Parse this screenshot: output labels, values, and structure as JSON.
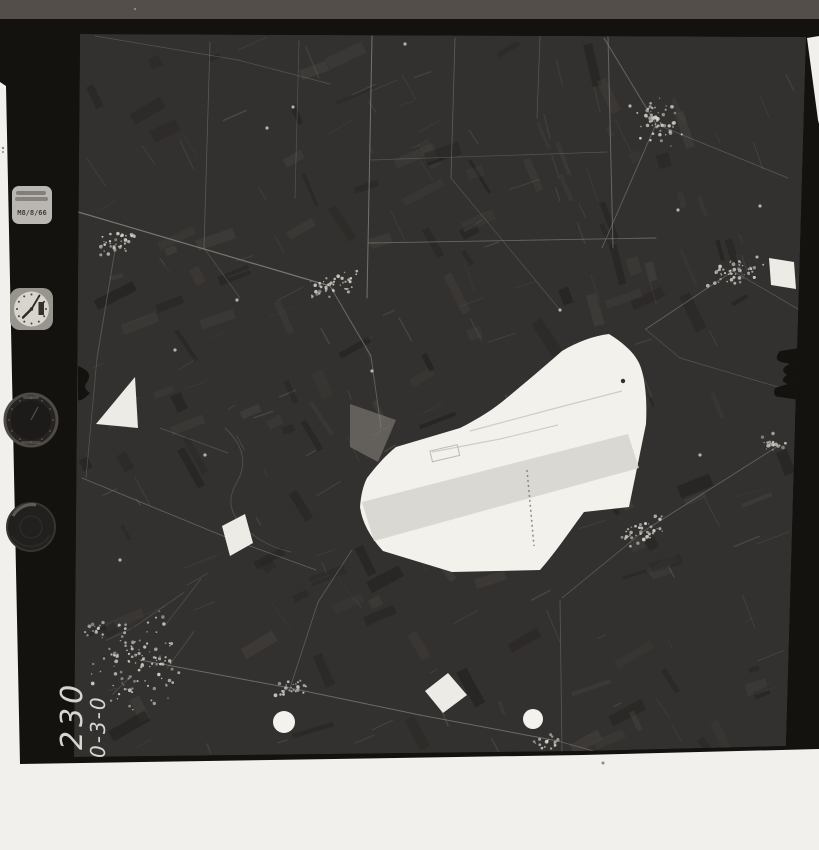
{
  "photo": {
    "frame_number": "230",
    "heading_marking": "0-3-0",
    "data_plate_text": "M8/8/66"
  },
  "colors": {
    "mat": "#f2f0ec",
    "film": "#14120f",
    "top_band": "#534e49",
    "image_base": "#33312f",
    "line_light": "#8b8883",
    "village_dot": "#d7d4cd",
    "airfield_white": "#f3f1ec",
    "runway_gray": "#d7d5cf",
    "patch_white": "#edebe5",
    "plate": "#c9c6c0",
    "clock_face": "#d8d5cf",
    "fiducial_white": "#f4f2ed"
  },
  "scene": {
    "film_outline": [
      [
        0,
        0
      ],
      [
        819,
        0
      ],
      [
        819,
        36
      ],
      [
        807,
        38
      ],
      [
        818,
        120
      ],
      [
        819,
        124
      ],
      [
        819,
        749
      ],
      [
        583,
        755
      ],
      [
        20,
        764
      ],
      [
        6,
        86
      ],
      [
        0,
        82
      ]
    ],
    "image_outline": [
      [
        80,
        34
      ],
      [
        806,
        37
      ],
      [
        786,
        746
      ],
      [
        583,
        751
      ],
      [
        74,
        757
      ]
    ],
    "top_band": [
      [
        0,
        0
      ],
      [
        819,
        0
      ],
      [
        819,
        19
      ],
      [
        0,
        19
      ]
    ],
    "roads": [
      [
        372,
        36,
        367,
        298,
        1.0,
        0.75
      ],
      [
        455,
        38,
        451,
        178,
        0.8,
        0.5
      ],
      [
        608,
        37,
        613,
        248,
        1.0,
        0.6
      ],
      [
        540,
        36,
        537,
        118,
        0.7,
        0.45
      ],
      [
        368,
        243,
        656,
        238,
        0.9,
        0.6
      ],
      [
        371,
        160,
        607,
        152,
        0.7,
        0.4
      ],
      [
        210,
        42,
        204,
        248,
        0.8,
        0.45
      ],
      [
        299,
        41,
        295,
        198,
        0.7,
        0.4
      ],
      [
        78,
        212,
        330,
        286,
        1.2,
        0.8
      ],
      [
        116,
        244,
        97,
        358,
        0.8,
        0.5
      ],
      [
        330,
        286,
        371,
        356,
        1.0,
        0.65
      ],
      [
        371,
        356,
        381,
        428,
        0.9,
        0.55
      ],
      [
        604,
        38,
        656,
        124,
        1.0,
        0.6
      ],
      [
        656,
        124,
        602,
        248,
        0.9,
        0.55
      ],
      [
        658,
        125,
        788,
        178,
        0.8,
        0.45
      ],
      [
        733,
        271,
        646,
        329,
        0.9,
        0.55
      ],
      [
        733,
        271,
        798,
        309,
        0.8,
        0.45
      ],
      [
        644,
        531,
        778,
        446,
        0.9,
        0.55
      ],
      [
        644,
        531,
        562,
        598,
        0.8,
        0.5
      ],
      [
        140,
        660,
        290,
        688,
        1.0,
        0.65
      ],
      [
        290,
        688,
        420,
        715,
        1.0,
        0.65
      ],
      [
        420,
        715,
        558,
        741,
        1.0,
        0.65
      ],
      [
        558,
        741,
        618,
        758,
        0.9,
        0.55
      ],
      [
        290,
        688,
        318,
        602,
        0.8,
        0.5
      ],
      [
        318,
        602,
        352,
        550,
        0.8,
        0.5
      ],
      [
        82,
        478,
        228,
        538,
        0.9,
        0.55
      ],
      [
        228,
        538,
        316,
        570,
        0.9,
        0.55
      ],
      [
        560,
        600,
        562,
        752,
        0.8,
        0.45
      ],
      [
        95,
        36,
        238,
        60,
        0.7,
        0.4
      ],
      [
        238,
        60,
        330,
        84,
        0.7,
        0.4
      ],
      [
        680,
        358,
        788,
        390,
        0.7,
        0.4
      ],
      [
        160,
        428,
        228,
        453,
        0.7,
        0.4
      ],
      [
        204,
        248,
        240,
        298,
        0.7,
        0.4
      ],
      [
        97,
        358,
        86,
        478,
        0.7,
        0.45
      ],
      [
        451,
        178,
        560,
        310,
        0.7,
        0.4
      ],
      [
        645,
        329,
        680,
        358,
        0.7,
        0.4
      ]
    ],
    "stream_path": "M225,428 q28,26 12,54 q-16,26 10,48 q18,16 44,22",
    "villages": [
      {
        "cx": 118,
        "cy": 242,
        "rx": 28,
        "ry": 14,
        "n": 40,
        "angle": -25
      },
      {
        "cx": 332,
        "cy": 286,
        "rx": 30,
        "ry": 12,
        "n": 45,
        "angle": -15
      },
      {
        "cx": 658,
        "cy": 125,
        "rx": 30,
        "ry": 24,
        "n": 55,
        "angle": 60
      },
      {
        "cx": 733,
        "cy": 272,
        "rx": 38,
        "ry": 14,
        "n": 50,
        "angle": -12
      },
      {
        "cx": 643,
        "cy": 532,
        "rx": 30,
        "ry": 12,
        "n": 40,
        "angle": -20
      },
      {
        "cx": 140,
        "cy": 660,
        "rx": 55,
        "ry": 48,
        "n": 115,
        "angle": -40
      },
      {
        "cx": 292,
        "cy": 688,
        "rx": 20,
        "ry": 10,
        "n": 28,
        "angle": -20
      },
      {
        "cx": 548,
        "cy": 742,
        "rx": 16,
        "ry": 8,
        "n": 20,
        "angle": -10
      },
      {
        "cx": 775,
        "cy": 442,
        "rx": 14,
        "ry": 10,
        "n": 18,
        "angle": 0
      },
      {
        "cx": 95,
        "cy": 628,
        "rx": 14,
        "ry": 8,
        "n": 14,
        "angle": -30
      }
    ],
    "specks": [
      [
        405,
        44
      ],
      [
        630,
        106
      ],
      [
        293,
        107
      ],
      [
        267,
        128
      ],
      [
        678,
        210
      ],
      [
        760,
        206
      ],
      [
        560,
        310
      ],
      [
        237,
        300
      ],
      [
        175,
        350
      ],
      [
        372,
        371
      ],
      [
        700,
        455
      ],
      [
        120,
        560
      ],
      [
        205,
        455
      ]
    ],
    "airfield_outline": "M609,334 C625,344 637,355 641,368 C646,383 647,404 646,424 L629,507 L584,512 C569,532 556,552 540,570 L452,572 L383,551 C370,537 362,522 360,507 C361,495 363,486 367,478 C376,466 386,455 396,447 L460,428 C478,419 494,409 508,397 C526,382 545,366 562,351 C577,342 593,336 609,334 Z",
    "pale_patch": [
      [
        350,
        404
      ],
      [
        396,
        420
      ],
      [
        378,
        462
      ],
      [
        350,
        447
      ]
    ],
    "runway_band": [
      [
        362,
        502
      ],
      [
        628,
        434
      ],
      [
        639,
        468
      ],
      [
        374,
        541
      ]
    ],
    "taxi_lines": [
      [
        [
          470,
          431
        ],
        [
          560,
          407
        ],
        [
          622,
          391
        ]
      ],
      [
        [
          432,
          452
        ],
        [
          500,
          439
        ],
        [
          558,
          425
        ]
      ]
    ],
    "apron_rect": {
      "x": 430,
      "y": 451,
      "w": 28,
      "h": 11,
      "angle": -13
    },
    "spec_dash": [
      527,
      470,
      534,
      546
    ],
    "aircraft_dot": [
      623,
      381
    ],
    "white_patches": [
      [
        [
          96,
          424
        ],
        [
          135,
          377
        ],
        [
          138,
          428
        ]
      ],
      [
        [
          222,
          526
        ],
        [
          245,
          514
        ],
        [
          253,
          543
        ],
        [
          230,
          556
        ]
      ],
      [
        [
          425,
          691
        ],
        [
          448,
          673
        ],
        [
          467,
          695
        ],
        [
          443,
          713
        ]
      ],
      [
        [
          769,
          258
        ],
        [
          794,
          262
        ],
        [
          796,
          289
        ],
        [
          771,
          285
        ]
      ]
    ],
    "fiducial_dots": [
      [
        284,
        722,
        11
      ],
      [
        533,
        719,
        10
      ]
    ],
    "mat_specks": [
      [
        3,
        148,
        1.2
      ],
      [
        3,
        152,
        1.0
      ],
      [
        603,
        763,
        1.5
      ],
      [
        135,
        9,
        1.2
      ]
    ],
    "notch_left": "M78,366 q16,6 9,16 q-5,6 3,11 q-9,9 -12,7 Z",
    "notch_right": "M800,348 l-20,3 q-7,8 1,11 l9,2 q-12,5 -3,11 q-9,6 1,9 l-13,4 q-3,9 5,9 l20,3 Z",
    "plate": {
      "x": 12,
      "y": 186,
      "w": 40,
      "h": 38
    },
    "clock": {
      "cx": 31.5,
      "cy": 309,
      "r": 17.5
    },
    "altimeter": {
      "cx": 31,
      "cy": 420,
      "r": 26
    },
    "compass": {
      "cx": 31,
      "cy": 527,
      "r": 24
    }
  }
}
